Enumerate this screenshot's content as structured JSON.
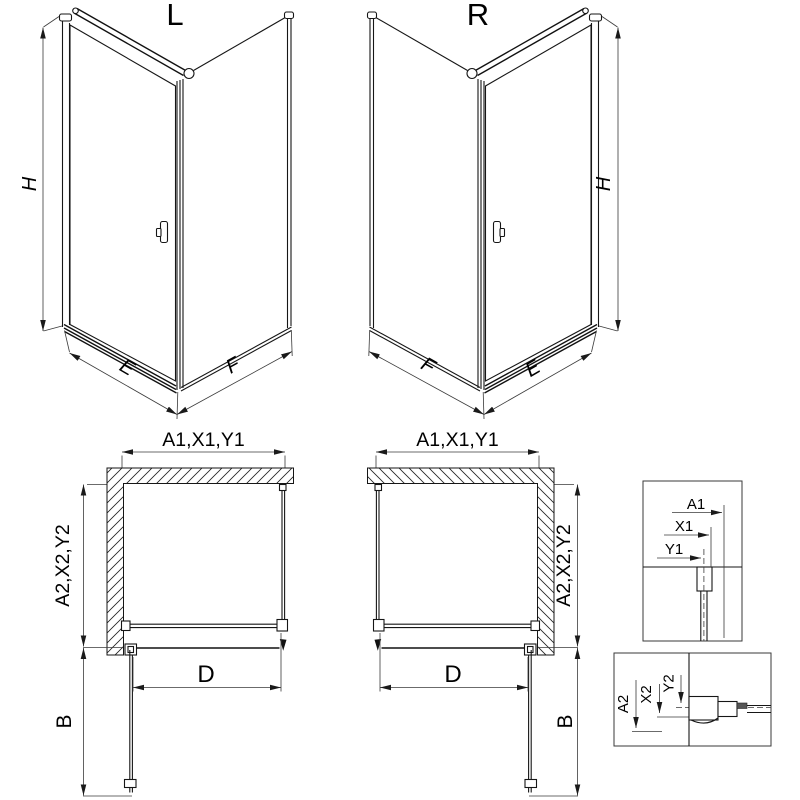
{
  "colors": {
    "line": "#1a1a1a",
    "dim_line": "#3a3a3a",
    "text": "#000000",
    "background": "#ffffff"
  },
  "views": {
    "iso_left": {
      "title": "L",
      "dims": {
        "height": "H",
        "front": "E",
        "side": "F"
      }
    },
    "iso_right": {
      "title": "R",
      "dims": {
        "height": "H",
        "front": "E",
        "side": "F"
      }
    },
    "plan_left": {
      "dim_top": "A1,X1,Y1",
      "dim_side": "A2,X2,Y2",
      "dim_entry": "D",
      "dim_door_open": "B"
    },
    "plan_right": {
      "dim_top": "A1,X1,Y1",
      "dim_side": "A2,X2,Y2",
      "dim_entry": "D",
      "dim_door_open": "B"
    },
    "detail_wall_profile": {
      "labels": {
        "a1": "A1",
        "x1": "X1",
        "y1": "Y1"
      }
    },
    "detail_bottom_profile": {
      "labels": {
        "a2": "A2",
        "x2": "X2",
        "y2": "Y2"
      }
    }
  }
}
